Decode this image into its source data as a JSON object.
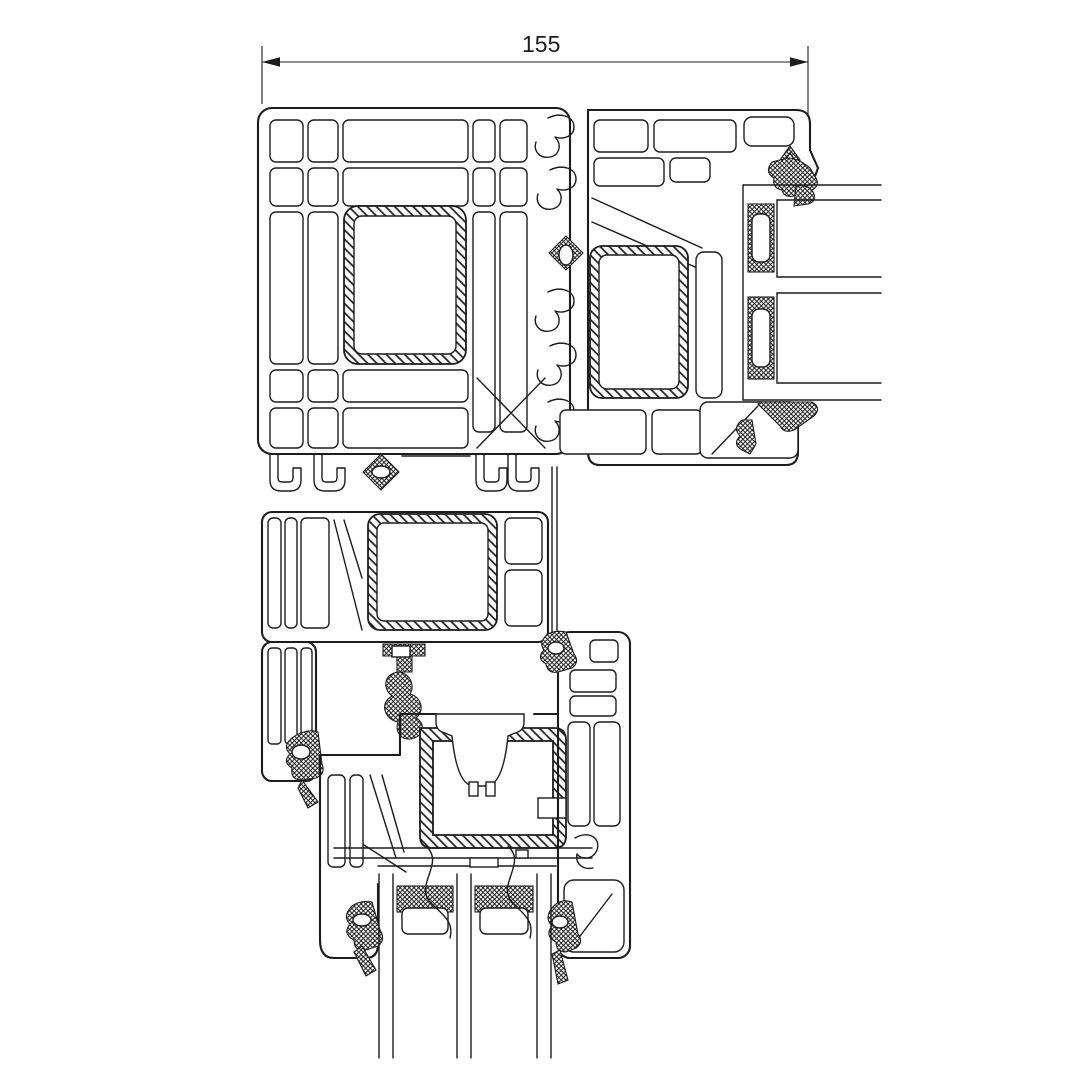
{
  "dimension": {
    "label": "155"
  },
  "colors": {
    "line": "#1c1c1c",
    "bg": "#ffffff"
  }
}
